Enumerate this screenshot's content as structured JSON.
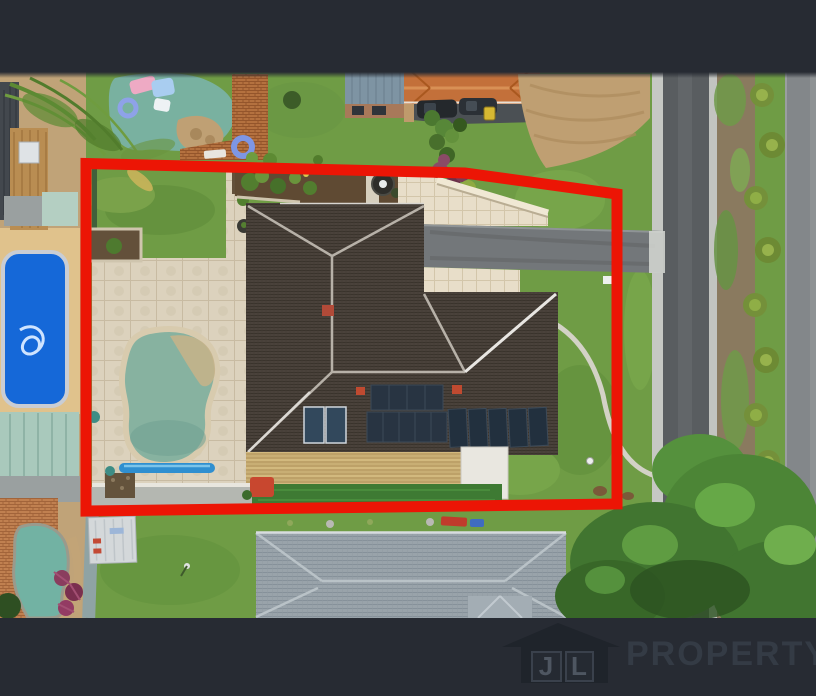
{
  "page": {
    "kind": "real-estate-aerial-photo",
    "size": "816x696"
  },
  "letterbox": {
    "top_bar_color": "#272b33",
    "bottom_bar_color": "#272b33"
  },
  "watermark": {
    "icon": "house-logo-icon",
    "initials": [
      "J",
      "L"
    ],
    "brand": "PROPERTY",
    "icon_color": "#1f242b",
    "initials_color": "#4e5661",
    "brand_color": "#343b45"
  },
  "boundary": {
    "color": "#ec1505",
    "width_px": 11,
    "role": "highlighted-property-outline"
  },
  "scene": {
    "subject_property": {
      "house_roof_color": "#4a423b",
      "pool": "kidney-shaped swimming pool",
      "pool_water_color": "#87b2a0",
      "solar_panels": "rooftop solar arrays",
      "driveway_color": "#73777a",
      "paving_color": "#dcd2bd",
      "lawn_color": "#6f9c45"
    },
    "street": {
      "road_color": "#595d60",
      "curb_color": "#c6c8c4",
      "footpath_color": "#83878a",
      "verge": "dirt verge with tufted bushes and street trees"
    },
    "neighbours": {
      "top_pool_color": "#79b1a0",
      "left_pool_color": "#1568d8",
      "bottom_roof_color": "#98a2a9",
      "orange_roof_color": "#c3703a"
    }
  }
}
